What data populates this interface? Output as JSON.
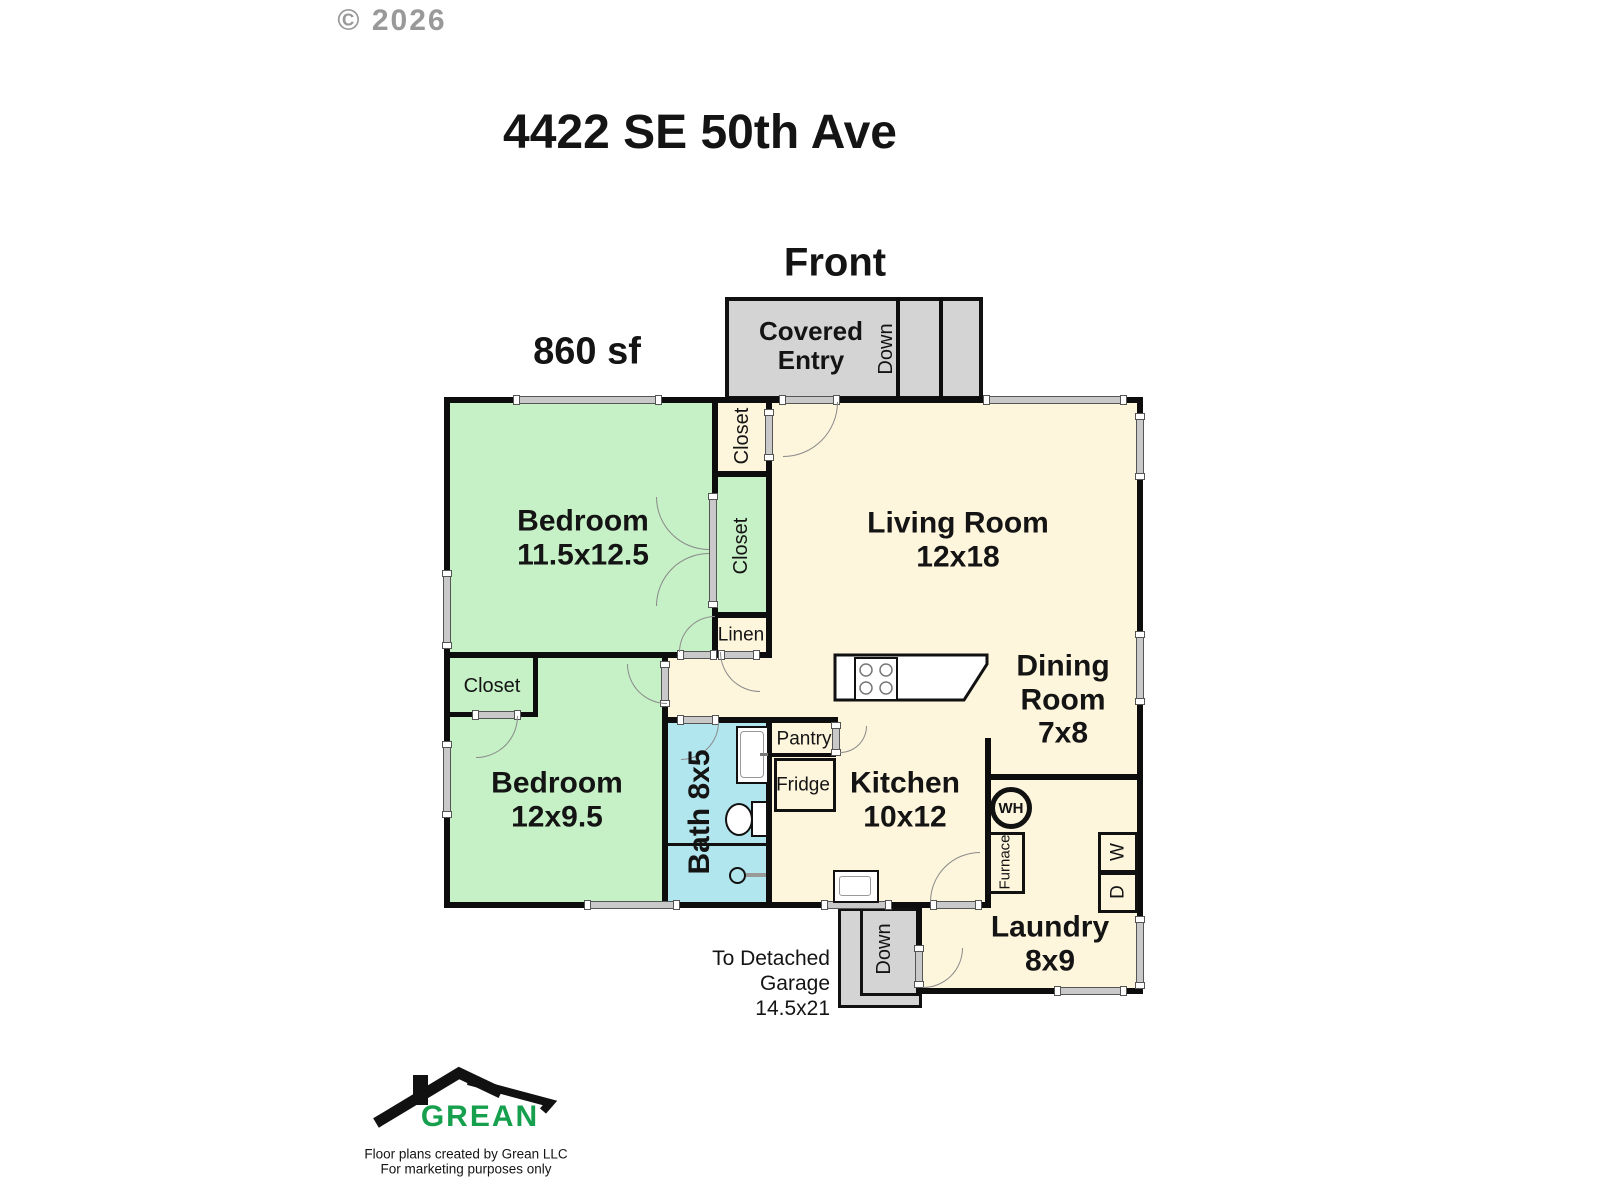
{
  "page": {
    "copyright": "© 2026",
    "title": "4422 SE 50th Ave",
    "front_label": "Front",
    "area_label": "860 sf"
  },
  "covered_entry": {
    "name": "Covered Entry",
    "down_label": "Down"
  },
  "rooms": {
    "bedroom1": {
      "name": "Bedroom",
      "dims": "11.5x12.5"
    },
    "living": {
      "name": "Living Room",
      "dims": "12x18"
    },
    "dining": {
      "name": "Dining Room",
      "dims": "7x8"
    },
    "kitchen": {
      "name": "Kitchen",
      "dims": "10x12"
    },
    "bedroom2": {
      "name": "Bedroom",
      "dims": "12x9.5"
    },
    "bath": {
      "name": "Bath 8x5"
    },
    "laundry": {
      "name": "Laundry",
      "dims": "8x9"
    }
  },
  "closets": {
    "entry": "Closet",
    "bedroom1": "Closet",
    "bedroom2": "Closet",
    "linen": "Linen"
  },
  "kitchen_items": {
    "pantry": "Pantry",
    "fridge": "Fridge"
  },
  "utilities": {
    "water_heater": "WH",
    "furnace": "Furnace",
    "washer": "W",
    "dryer": "D"
  },
  "stairs": {
    "garage_down": "Down"
  },
  "garage_note": {
    "line1": "To Detached",
    "line2": "Garage",
    "line3": "14.5x21"
  },
  "branding": {
    "logo_text": "GREAN",
    "tagline1": "Floor plans created by Grean LLC",
    "tagline2": "For marketing purposes only"
  },
  "colors": {
    "bedroom_green": "#c6f0c6",
    "living_cream": "#fdf5dc",
    "bath_blue": "#b2e6ee",
    "entry_gray": "#d4d4d4",
    "brand_green": "#16a04e"
  }
}
